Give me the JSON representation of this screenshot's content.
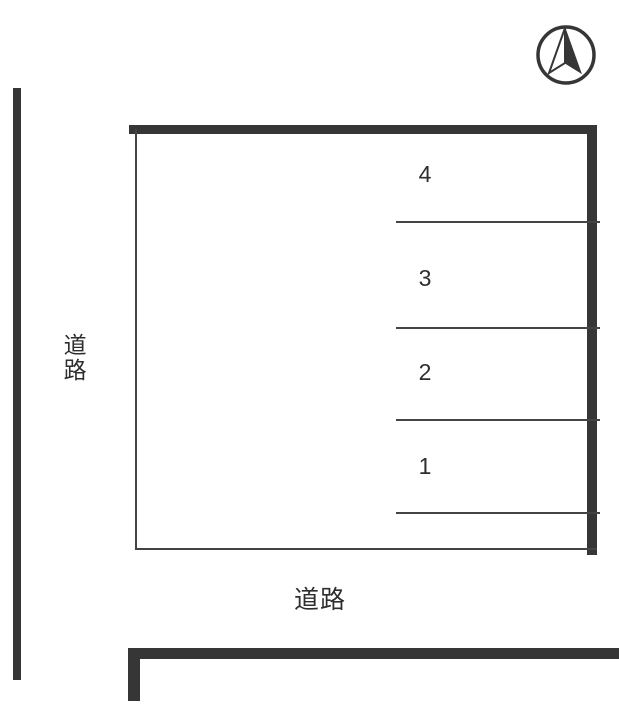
{
  "diagram": {
    "type": "parking-lot-site-plan",
    "orientation_icon": "north-compass",
    "road_left": {
      "label": "道路"
    },
    "road_bottom": {
      "label": "道路"
    },
    "parking_spaces": [
      {
        "number": "4"
      },
      {
        "number": "3"
      },
      {
        "number": "2"
      },
      {
        "number": "1"
      }
    ],
    "colors": {
      "outline_dark": "#363636",
      "thin_line": "#444444",
      "text": "#2e2e2e",
      "background": "#ffffff"
    }
  }
}
